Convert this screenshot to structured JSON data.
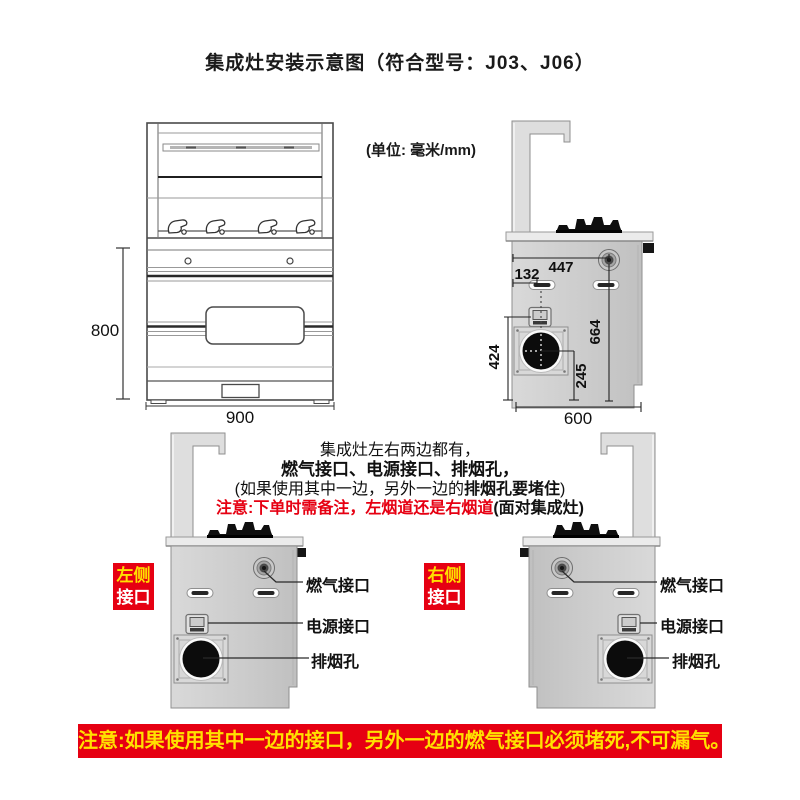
{
  "title": "集成灶安装示意图（符合型号：J03、J06）",
  "units_note": "(单位: 毫米/mm)",
  "front_view": {
    "height_dim": "800",
    "width_dim": "900"
  },
  "side_view": {
    "top_width_dim": "447",
    "slot_offset_dim": "132",
    "gas_height_dim": "664",
    "exhaust_top_dim": "424",
    "exhaust_center_dim": "245",
    "depth_dim": "600"
  },
  "info": {
    "line1": "集成灶左右两边都有，",
    "line2": "燃气接口、电源接口、排烟孔，",
    "line3_pre": "(如果使用其中一边，另外一边的",
    "line3_bold": "排烟孔要堵住",
    "line3_post": ")",
    "line4_red": "注意:下单时需备注，左烟道还是右烟道",
    "line4_black": "(面对集成灶)"
  },
  "left_diagram": {
    "badge_top": "左侧",
    "badge_bottom": "接口",
    "gas_label": "燃气接口",
    "power_label": "电源接口",
    "exhaust_label": "排烟孔"
  },
  "right_diagram": {
    "badge_top": "右侧",
    "badge_bottom": "接口",
    "gas_label": "燃气接口",
    "power_label": "电源接口",
    "exhaust_label": "排烟孔"
  },
  "warning": "注意:如果使用其中一边的接口，另外一边的燃气接口必须堵死,不可漏气。",
  "colors": {
    "accent_red": "#e60012",
    "accent_yellow": "#ffe100",
    "text_black": "#111111"
  }
}
